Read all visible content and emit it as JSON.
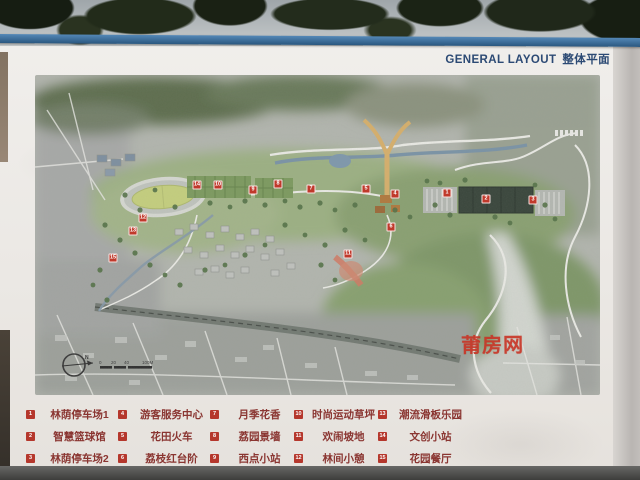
{
  "sign": {
    "title_en": "GENERAL LAYOUT",
    "title_zh": "整体平面",
    "watermark": "莆房网",
    "compass_label": "N",
    "scale_labels": [
      "0",
      "20",
      "40",
      "100M"
    ]
  },
  "legend": {
    "items": [
      {
        "num": "1",
        "label": "林荫停车场1"
      },
      {
        "num": "2",
        "label": "智慧篮球馆"
      },
      {
        "num": "3",
        "label": "林荫停车场2"
      },
      {
        "num": "4",
        "label": "游客服务中心"
      },
      {
        "num": "5",
        "label": "花田火车"
      },
      {
        "num": "6",
        "label": "荔枝红台阶"
      },
      {
        "num": "7",
        "label": "月季花香"
      },
      {
        "num": "8",
        "label": "荔园景墙"
      },
      {
        "num": "9",
        "label": "西点小站"
      },
      {
        "num": "10",
        "label": "时尚运动草坪"
      },
      {
        "num": "11",
        "label": "欢闹坡地"
      },
      {
        "num": "12",
        "label": "林间小憩"
      },
      {
        "num": "13",
        "label": "潮流滑板乐园"
      },
      {
        "num": "14",
        "label": "文创小站"
      },
      {
        "num": "15",
        "label": "花园餐厅"
      }
    ]
  },
  "map": {
    "markers": [
      {
        "num": "1",
        "x": 412,
        "y": 118
      },
      {
        "num": "2",
        "x": 451,
        "y": 124
      },
      {
        "num": "3",
        "x": 498,
        "y": 125
      },
      {
        "num": "4",
        "x": 360,
        "y": 119
      },
      {
        "num": "5",
        "x": 331,
        "y": 114
      },
      {
        "num": "6",
        "x": 356,
        "y": 152
      },
      {
        "num": "7",
        "x": 276,
        "y": 114
      },
      {
        "num": "8",
        "x": 243,
        "y": 109
      },
      {
        "num": "9",
        "x": 218,
        "y": 115
      },
      {
        "num": "10",
        "x": 183,
        "y": 110
      },
      {
        "num": "11",
        "x": 313,
        "y": 179
      },
      {
        "num": "12",
        "x": 108,
        "y": 143
      },
      {
        "num": "13",
        "x": 98,
        "y": 156
      },
      {
        "num": "14",
        "x": 162,
        "y": 110
      },
      {
        "num": "15",
        "x": 78,
        "y": 183
      }
    ],
    "colors": {
      "marker": "#c0392b",
      "rail_blue": "#2a577f",
      "title_blue": "#2c4a74",
      "legend_text": "#8a3531",
      "watermark_red": "#c93425"
    }
  }
}
